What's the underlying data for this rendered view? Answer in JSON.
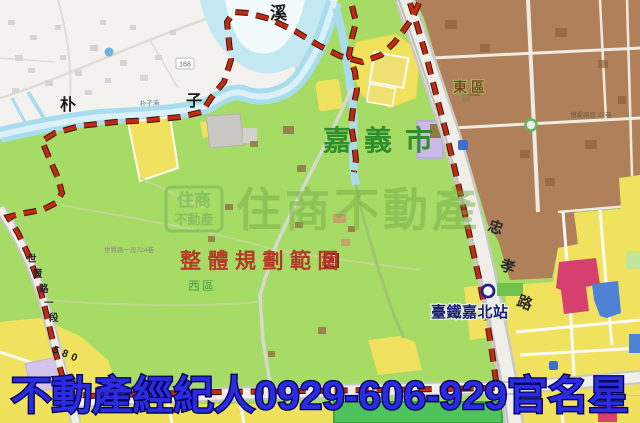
{
  "colors": {
    "land_green": "#A6DB65",
    "town_white": "#F3F2EE",
    "river_cyan": "#A9DCEC",
    "urban_brown": "#B0805A",
    "zone_yellow": "#F0E25F",
    "park_green": "#4EC35C",
    "boundary_red": "#C22B12",
    "pink_zone": "#D6406E",
    "blue_zone": "#4E82D4",
    "purple_zone": "#CBB9E9",
    "banner_blue": "#2B2BE0",
    "banner_outline": "#000055",
    "station_blue": "#1B1B78",
    "planning_red": "#B23A26",
    "city_green": "#2F8F2F"
  },
  "map": {
    "city_label": "嘉義市",
    "district_east": "東區",
    "district_west": "西區",
    "planning_area": "整體規劃範圍",
    "river_chars": [
      "朴",
      "子",
      "溪"
    ],
    "river_name_small": "朴子溪",
    "station": {
      "name": "臺鐵嘉北站"
    },
    "roads": {
      "zhongxiao_chars": [
        "忠",
        "孝",
        "路"
      ],
      "shixian_chars": [
        "世",
        "賢",
        "路",
        "一",
        "段"
      ],
      "shixian_number": "580",
      "lane_label": "世賢路一段724巷",
      "boai_lane_label": "博愛路段 27巷",
      "route_marker": "168"
    },
    "watermark": {
      "logo_line1": "住商",
      "logo_line2": "不動產",
      "text": "住商不動產"
    }
  },
  "banner": {
    "text": "不動產經紀人0929-606-929官名星"
  }
}
